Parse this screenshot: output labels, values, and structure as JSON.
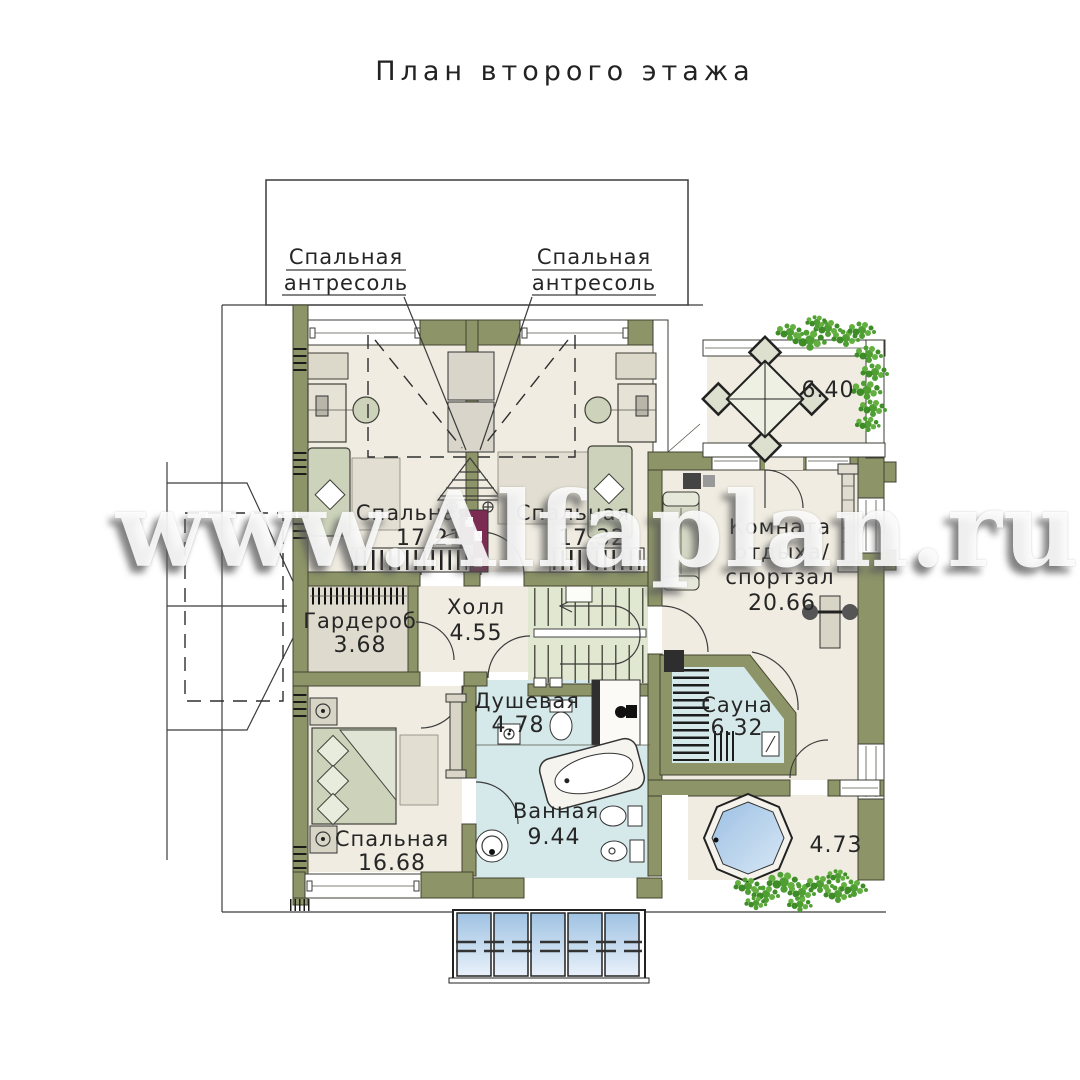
{
  "title": "План второго этажа",
  "watermark": "www.Alfaplan.ru",
  "callouts": {
    "left": {
      "line1": "Спальная",
      "line2": "антресоль"
    },
    "right": {
      "line1": "Спальная",
      "line2": "антресоль"
    }
  },
  "rooms": {
    "bedroom1": {
      "name": "Спальная",
      "area": "17.21"
    },
    "bedroom2": {
      "name": "Спальная",
      "area": "17.32"
    },
    "hall": {
      "name": "Холл",
      "area": "4.55"
    },
    "wardrobe": {
      "name": "Гардероб",
      "area": "3.68"
    },
    "shower": {
      "name": "Душевая",
      "area": "4.78"
    },
    "bath": {
      "name": "Ванная",
      "area": "9.44"
    },
    "bedroom3": {
      "name": "Спальная",
      "area": "16.68"
    },
    "lounge": {
      "line1": "Комната",
      "line2": "отдыха/",
      "line3": "спортзал",
      "area": "20.66"
    },
    "sauna": {
      "name": "Сауна",
      "area": "6.32"
    },
    "balcony_top": {
      "area": "6.40"
    },
    "balcony_bottom": {
      "area": "4.73"
    }
  },
  "colors": {
    "wall": "#8c9468",
    "floor": "#f0ece1",
    "wet_floor": "#d6e9ea",
    "stair_floor": "#e0e8d1",
    "glass": "#a9c8e6",
    "flue": "#7c2b52",
    "plant": "#4f9e33",
    "line": "#333333",
    "watermark": "rgba(255,255,255,0.88)"
  }
}
